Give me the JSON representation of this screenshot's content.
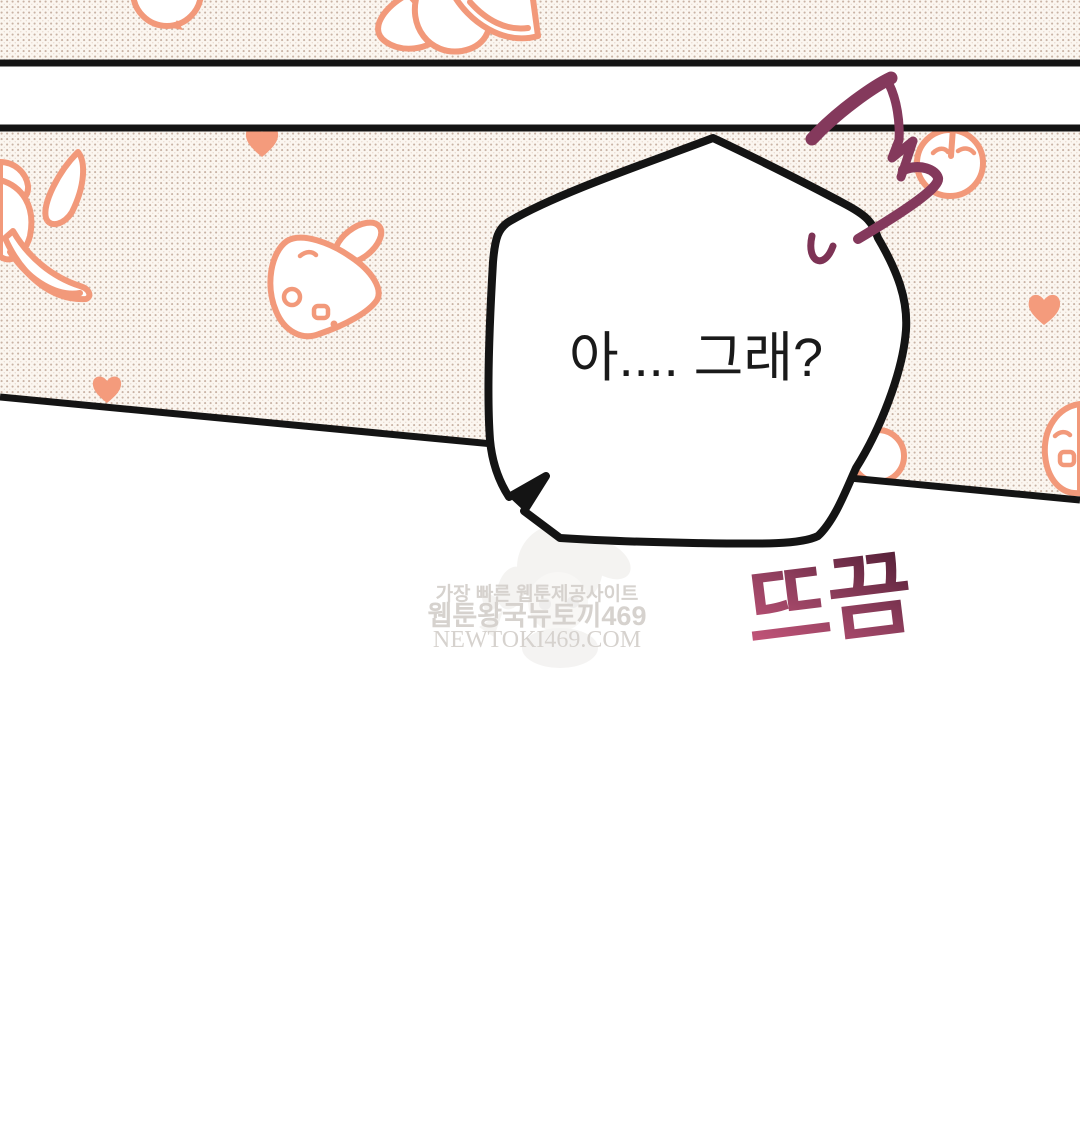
{
  "speech_bubble": {
    "text": "아.... 그래?"
  },
  "sfx": {
    "startle_text": "뜨끔"
  },
  "watermark": {
    "line1": "가장 빠른 웹툰제공사이트",
    "line2": "웹툰왕국뉴토끼469",
    "line3": "NEWTOKI469.COM"
  },
  "colors": {
    "ink": "#141414",
    "panel_base": "#fbf6f0",
    "halftone_dot": "#c9b3a5",
    "halftone_dot_light": "#ddcabe",
    "pattern_accent": "#f2997a",
    "heart_fill": "#f49b7c",
    "squiggle_maroon": "#84395c",
    "sweat_maroon": "#7d3355",
    "sfx_pink": "#d05a80",
    "sfx_mid": "#93405f",
    "sfx_dark": "#4e1c33",
    "bubble_text": "#1a1a1a",
    "watermark_gray": "#d6d2ce"
  }
}
